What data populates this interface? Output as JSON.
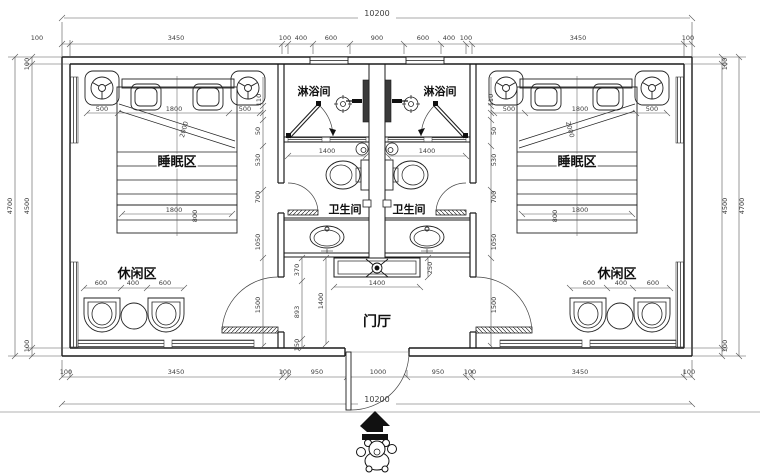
{
  "labels": {
    "sleeping": "睡眠区",
    "leisure": "休闲区",
    "shower": "淋浴间",
    "toilet": "卫生间",
    "hall": "门厅"
  },
  "dims": {
    "top_total": "10200",
    "top": [
      "100",
      "3450",
      "100",
      "400",
      "600",
      "900",
      "600",
      "400",
      "100",
      "3450",
      "100"
    ],
    "bottom": [
      "100",
      "3450",
      "100",
      "950",
      "1000",
      "950",
      "100",
      "3450",
      "100"
    ],
    "bottom_total": "10200",
    "side": {
      "outer": "4700",
      "inner": "4500",
      "wall": "100"
    },
    "bed": {
      "side": "500",
      "width": "1800",
      "diag": "2000",
      "foot": "1800",
      "foot_d": "800",
      "offset": "110"
    },
    "leisure": {
      "chair": "600",
      "table": "400"
    },
    "wc_width": "1400",
    "console": {
      "width": "1400",
      "depth": "250"
    },
    "hall": {
      "a": "370",
      "b": "893",
      "c": "150",
      "h": "1400"
    },
    "door_h": "1500",
    "col": [
      "50",
      "530",
      "700",
      "1050"
    ]
  },
  "colors": {
    "line": "#1b1b1b",
    "dimline": "#555555",
    "fill_dark": "#3a3a3a"
  }
}
